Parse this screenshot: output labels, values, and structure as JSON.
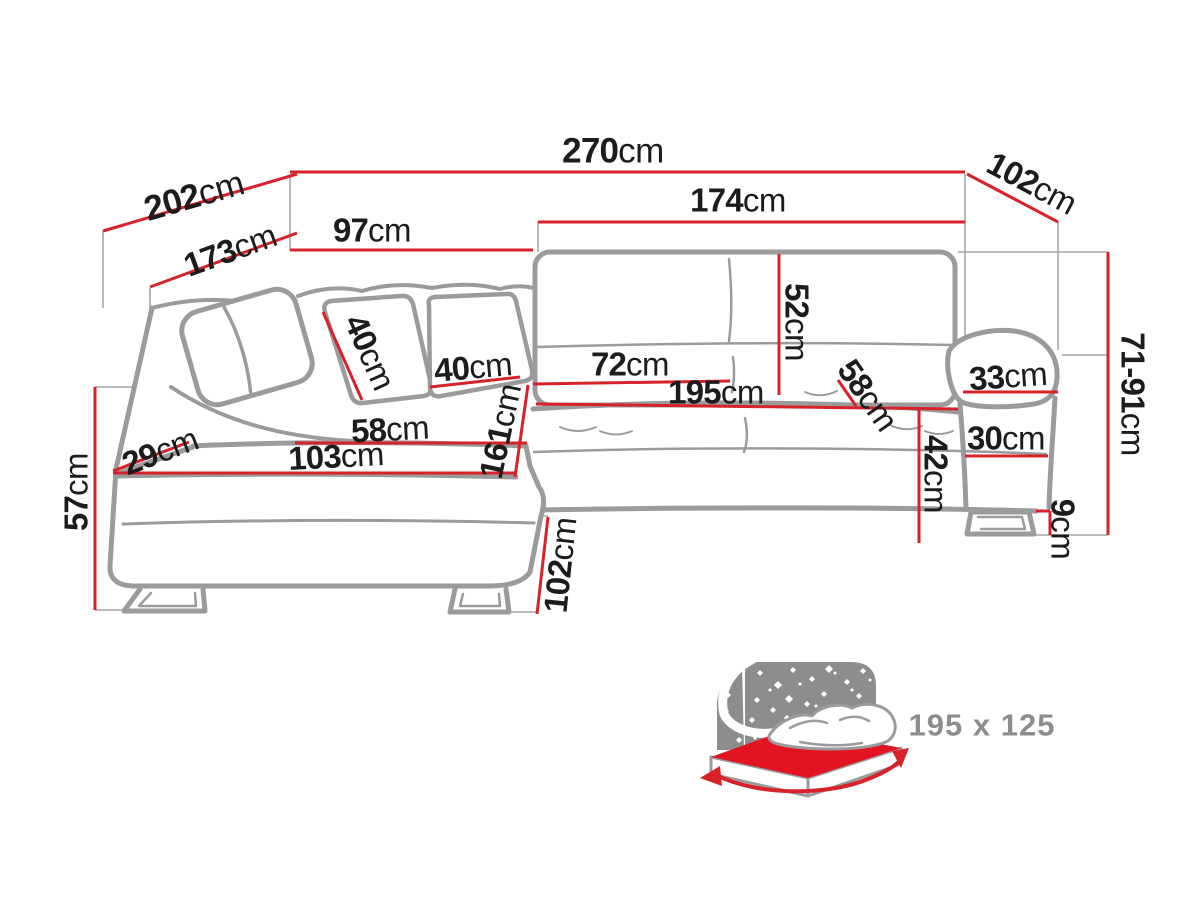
{
  "diagram": {
    "type": "corner-sofa-dimension-drawing",
    "unit_default": "cm",
    "dimensions": [
      {
        "id": "overall-top-width",
        "value": "270",
        "unit": "cm"
      },
      {
        "id": "back-diagonal-left",
        "value": "202",
        "unit": "cm"
      },
      {
        "id": "seat-diagonal-left",
        "value": "173",
        "unit": "cm"
      },
      {
        "id": "back-left-width",
        "value": "97",
        "unit": "cm"
      },
      {
        "id": "right-section-width",
        "value": "174",
        "unit": "cm"
      },
      {
        "id": "top-right-depth",
        "value": "102",
        "unit": "cm"
      },
      {
        "id": "height-range",
        "value": "71-91",
        "unit": "cm"
      },
      {
        "id": "backrest-height",
        "value": "52",
        "unit": "cm"
      },
      {
        "id": "seat-cushion-width",
        "value": "72",
        "unit": "cm"
      },
      {
        "id": "sleeping-length",
        "value": "195",
        "unit": "cm"
      },
      {
        "id": "chaise-seat-width",
        "value": "58",
        "unit": "cm"
      },
      {
        "id": "chaise-length",
        "value": "103",
        "unit": "cm"
      },
      {
        "id": "left-arm-height",
        "value": "29",
        "unit": "cm"
      },
      {
        "id": "chaise-depth",
        "value": "161",
        "unit": "cm"
      },
      {
        "id": "pillow-height",
        "value": "40",
        "unit": "cm"
      },
      {
        "id": "pillow-width",
        "value": "40",
        "unit": "cm"
      },
      {
        "id": "right-seat-depth",
        "value": "58",
        "unit": "cm"
      },
      {
        "id": "armrest-top-width",
        "value": "33",
        "unit": "cm"
      },
      {
        "id": "armrest-front-width",
        "value": "30",
        "unit": "cm"
      },
      {
        "id": "seat-height",
        "value": "42",
        "unit": "cm"
      },
      {
        "id": "leg-height",
        "value": "9",
        "unit": "cm"
      },
      {
        "id": "side-height",
        "value": "57",
        "unit": "cm"
      },
      {
        "id": "chaise-front-depth",
        "value": "102",
        "unit": "cm"
      }
    ]
  },
  "bed": {
    "size_label": "195 x 125",
    "icon": "bed-sleeping-area-icon"
  },
  "colors": {
    "dimension_red": "#d7222a",
    "mattress_red": "#e31421",
    "sofa_outline_gray": "#9b9b9b",
    "extension_line_gray": "#a6a6a6",
    "icon_gray": "#8d8d8d",
    "label_black": "#1c1c1c"
  }
}
